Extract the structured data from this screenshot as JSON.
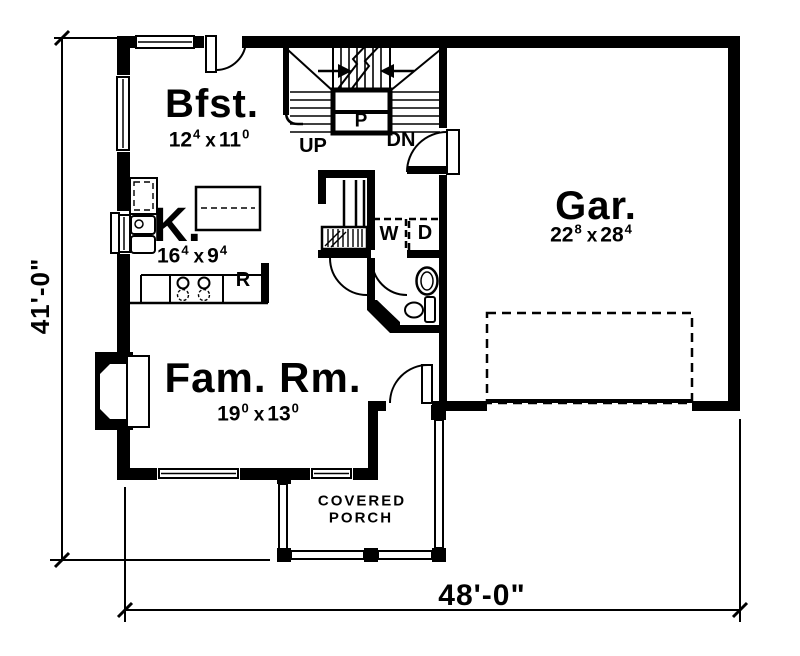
{
  "rooms": {
    "breakfast": {
      "name": "Bfst.",
      "dim_w": "12",
      "dim_w_sup": "4",
      "dim_sep": "x",
      "dim_h": "11",
      "dim_h_sup": "0"
    },
    "kitchen": {
      "name": "K.",
      "dim_w": "16",
      "dim_w_sup": "4",
      "dim_sep": "x",
      "dim_h": "9",
      "dim_h_sup": "4"
    },
    "garage": {
      "name": "Gar.",
      "dim_w": "22",
      "dim_w_sup": "8",
      "dim_sep": "x",
      "dim_h": "28",
      "dim_h_sup": "4"
    },
    "family_room": {
      "name": "Fam. Rm.",
      "dim_w": "19",
      "dim_w_sup": "0",
      "dim_sep": "x",
      "dim_h": "13",
      "dim_h_sup": "0"
    },
    "covered_porch": {
      "line1": "COVERED",
      "line2": "PORCH"
    }
  },
  "stairs": {
    "up_label": "UP",
    "down_label": "DN",
    "pantry_label": "P"
  },
  "fixtures": {
    "washer_label": "W",
    "dryer_label": "D",
    "refrigerator_label": "R"
  },
  "overall_dimensions": {
    "left": "41'-0\"",
    "bottom": "48'-0\""
  },
  "colors": {
    "ink": "#000000",
    "background": "#ffffff"
  }
}
